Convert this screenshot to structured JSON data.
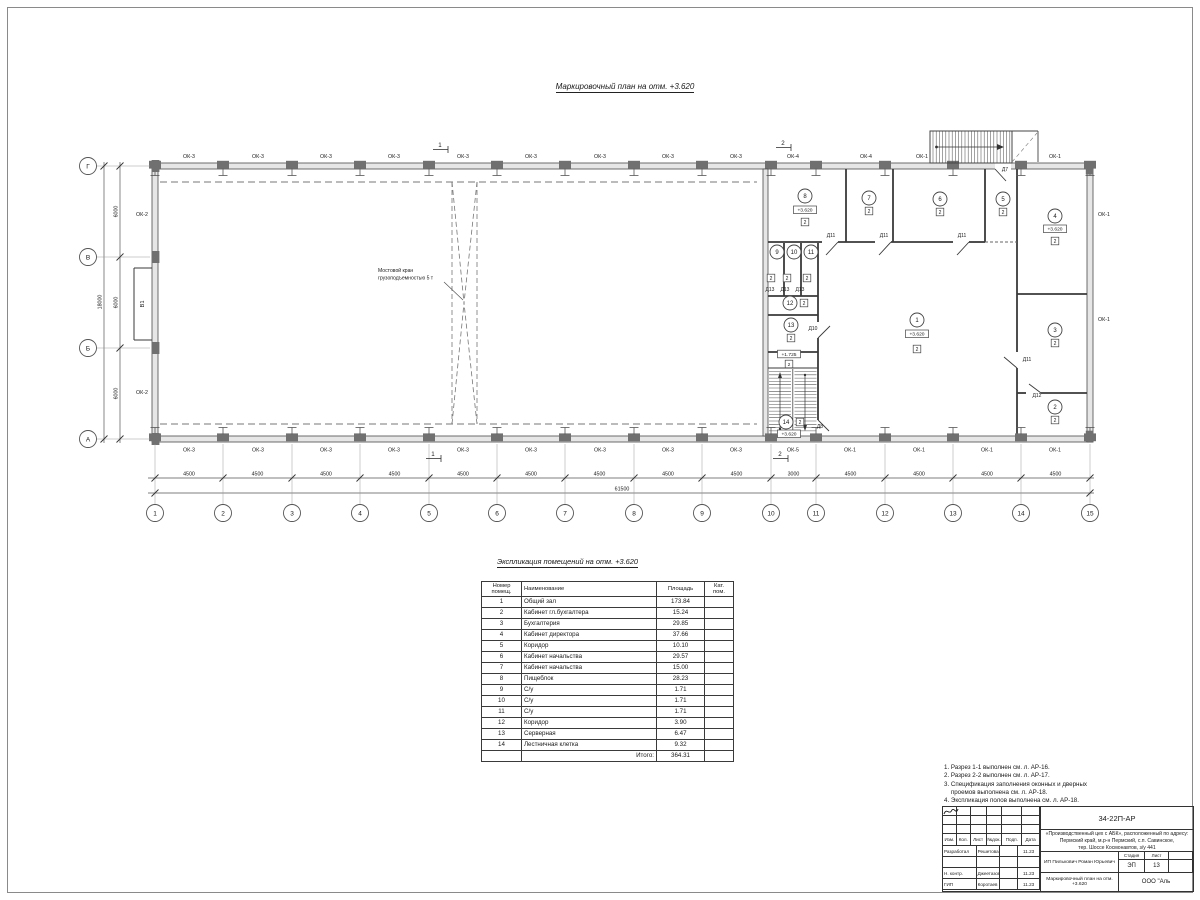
{
  "plan_title": "Маркировочный план  на отм. +3.620",
  "plan": {
    "axes_bottom": [
      "1",
      "2",
      "3",
      "4",
      "5",
      "6",
      "7",
      "8",
      "9",
      "10",
      "11",
      "12",
      "13",
      "14",
      "15"
    ],
    "axes_left": [
      "Г",
      "В",
      "Б",
      "А"
    ],
    "dims_bottom": [
      "4500",
      "4500",
      "4500",
      "4500",
      "4500",
      "4500",
      "4500",
      "4500",
      "4500",
      "3000",
      "4500",
      "4500",
      "4500",
      "4500"
    ],
    "dim_bottom_total": "61500",
    "dims_left": [
      "6000",
      "6000",
      "6000"
    ],
    "dim_left_total": "18000",
    "windows_top": [
      {
        "t": "ОК-3",
        "x": 189
      },
      {
        "t": "ОК-3",
        "x": 258
      },
      {
        "t": "ОК-3",
        "x": 326
      },
      {
        "t": "ОК-3",
        "x": 394
      },
      {
        "t": "ОК-3",
        "x": 463
      },
      {
        "t": "ОК-3",
        "x": 531
      },
      {
        "t": "ОК-3",
        "x": 600
      },
      {
        "t": "ОК-3",
        "x": 668
      },
      {
        "t": "ОК-3",
        "x": 736
      },
      {
        "t": "ОК-4",
        "x": 793
      },
      {
        "t": "ОК-4",
        "x": 866
      },
      {
        "t": "ОК-1",
        "x": 922
      },
      {
        "t": "ОК-1",
        "x": 1055
      }
    ],
    "windows_bottom": [
      {
        "t": "ОК-3",
        "x": 189
      },
      {
        "t": "ОК-3",
        "x": 258
      },
      {
        "t": "ОК-3",
        "x": 326
      },
      {
        "t": "ОК-3",
        "x": 394
      },
      {
        "t": "ОК-3",
        "x": 463
      },
      {
        "t": "ОК-3",
        "x": 531
      },
      {
        "t": "ОК-3",
        "x": 600
      },
      {
        "t": "ОК-3",
        "x": 668
      },
      {
        "t": "ОК-3",
        "x": 736
      },
      {
        "t": "ОК-5",
        "x": 793
      },
      {
        "t": "ОК-1",
        "x": 850
      },
      {
        "t": "ОК-1",
        "x": 919
      },
      {
        "t": "ОК-1",
        "x": 987
      },
      {
        "t": "ОК-1",
        "x": 1055
      }
    ],
    "windows_side": [
      {
        "t": "ОК-2",
        "x": 142,
        "y": 216
      },
      {
        "t": "ОК-2",
        "x": 142,
        "y": 394
      },
      {
        "t": "ОК-1",
        "x": 1098,
        "y": 216,
        "a": "start"
      },
      {
        "t": "ОК-1",
        "x": 1098,
        "y": 321,
        "a": "start"
      }
    ],
    "crane_note": [
      "Мостовой кран",
      "грузоподъемностью 5 т"
    ],
    "shaft_label": "В1",
    "rooms": [
      {
        "n": "1",
        "cx": 917,
        "cy": 320,
        "elev": "+3.620",
        "ex": 917,
        "ey": 334,
        "eb": true,
        "cat": "2",
        "kx": 917,
        "ky": 349
      },
      {
        "n": "2",
        "cx": 1055,
        "cy": 407,
        "cat": "2",
        "kx": 1055,
        "ky": 420
      },
      {
        "n": "3",
        "cx": 1055,
        "cy": 330,
        "cat": "2",
        "kx": 1055,
        "ky": 343
      },
      {
        "n": "4",
        "cx": 1055,
        "cy": 216,
        "elev": "+3.620",
        "ex": 1055,
        "ey": 229,
        "eb": true,
        "cat": "2",
        "kx": 1055,
        "ky": 241
      },
      {
        "n": "5",
        "cx": 1003,
        "cy": 199,
        "cat": "2",
        "kx": 1003,
        "ky": 212
      },
      {
        "n": "6",
        "cx": 940,
        "cy": 199,
        "cat": "2",
        "kx": 940,
        "ky": 212
      },
      {
        "n": "7",
        "cx": 869,
        "cy": 198,
        "cat": "2",
        "kx": 869,
        "ky": 211
      },
      {
        "n": "8",
        "cx": 805,
        "cy": 196,
        "elev": "+3.620",
        "ex": 805,
        "ey": 210,
        "eb": true,
        "cat": "2",
        "kx": 805,
        "ky": 222
      },
      {
        "n": "9",
        "cx": 777,
        "cy": 252,
        "cat": "2",
        "kx": 771,
        "ky": 278
      },
      {
        "n": "10",
        "cx": 794,
        "cy": 252,
        "cat": "2",
        "kx": 787,
        "ky": 278
      },
      {
        "n": "11",
        "cx": 811,
        "cy": 252,
        "cat": "2",
        "kx": 807,
        "ky": 278
      },
      {
        "n": "12",
        "cx": 790,
        "cy": 303,
        "cat": "2",
        "kx": 804,
        "ky": 303
      },
      {
        "n": "13",
        "cx": 791,
        "cy": 325,
        "cat": "2",
        "kx": 791,
        "ky": 338
      },
      {
        "n": "14",
        "cx": 786,
        "cy": 422,
        "cat": "2",
        "kx": 800,
        "ky": 422,
        "elev": "+3.620",
        "ex": 789,
        "ey": 434,
        "eb": true
      }
    ],
    "marks": [
      {
        "t": "+1.725",
        "x": 789,
        "y": 354
      },
      {
        "t": "2",
        "x": 789,
        "y": 364
      }
    ],
    "doors": [
      {
        "t": "Д7",
        "x": 1005,
        "y": 171
      },
      {
        "t": "Д11",
        "x": 831,
        "y": 237
      },
      {
        "t": "Д11",
        "x": 884,
        "y": 237
      },
      {
        "t": "Д11",
        "x": 962,
        "y": 237
      },
      {
        "t": "Д11",
        "x": 1027,
        "y": 361
      },
      {
        "t": "Д12",
        "x": 1037,
        "y": 397
      },
      {
        "t": "Д10",
        "x": 813,
        "y": 330
      },
      {
        "t": "Д13",
        "x": 770,
        "y": 291
      },
      {
        "t": "Д13",
        "x": 785,
        "y": 291
      },
      {
        "t": "Д13",
        "x": 800,
        "y": 291
      },
      {
        "t": "Д8",
        "x": 820,
        "y": 428
      }
    ],
    "sections": [
      {
        "t": "1",
        "x": 440,
        "y": 147
      },
      {
        "t": "1",
        "x": 433,
        "y": 456
      },
      {
        "t": "2",
        "x": 783,
        "y": 145
      },
      {
        "t": "2",
        "x": 780,
        "y": 456
      }
    ]
  },
  "table": {
    "title": "Экспликация помещений на отм. +3.620",
    "headers": [
      "Номер\nпомещ.",
      "Наименование",
      "Площадь",
      "Кат.\nпом."
    ],
    "rows": [
      [
        "1",
        "Общий зал",
        "173.84"
      ],
      [
        "2",
        "Кабинет гл.бухгалтера",
        "15.24"
      ],
      [
        "3",
        "Бухгалтерия",
        "29.85"
      ],
      [
        "4",
        "Кабинет директора",
        "37.66"
      ],
      [
        "5",
        "Коридор",
        "10.10"
      ],
      [
        "6",
        "Кабинет начальства",
        "29.57"
      ],
      [
        "7",
        "Кабинет начальства",
        "15.00"
      ],
      [
        "8",
        "Пищеблок",
        "28.23"
      ],
      [
        "9",
        "С/у",
        "1.71"
      ],
      [
        "10",
        "С/у",
        "1.71"
      ],
      [
        "11",
        "С/у",
        "1.71"
      ],
      [
        "12",
        "Коридор",
        "3.90"
      ],
      [
        "13",
        "Серверная",
        "6.47"
      ],
      [
        "14",
        "Лестничная клетка",
        "9.32"
      ]
    ],
    "total_label": "Итого:",
    "total_value": "364.31"
  },
  "notes": [
    "1. Разрез 1-1 выполнен см. л. АР-16.",
    "2. Разрез 2-2 выполнен см. л. АР-17.",
    "3. Спецификация заполнения оконных и дверных",
    "    проемов выполнена см. л. АР-18.",
    "4. Экспликация полов выполнена см. л. АР-18."
  ],
  "titleblock": {
    "doc_number": "34-22П-АР",
    "project": [
      "«Производственный цех с АБК», расположенный по адресу:",
      "Пермский край, м.р-н Пермский, с.п. Савинское,",
      "тер. Шоссе Космонавтов, з/у 441"
    ],
    "cols": [
      "Изм.",
      "Кол.",
      "Лист",
      "№док.",
      "Подп.",
      "Дата"
    ],
    "sign_rows": [
      [
        "Разработал",
        "Решетова",
        "11.23"
      ],
      [
        "",
        "",
        ""
      ],
      [
        "Н. контр.",
        "Джеетазов",
        "11.23"
      ],
      [
        "ГИП",
        "Коротаев",
        "11.23"
      ]
    ],
    "client": "ИП Пилькович Роман Юрьевич",
    "stage_label": "Стадия",
    "sheet_label": "Лист",
    "stage": "ЭП",
    "sheet": "13",
    "drawing_title": "Маркировочный план на отм. +3.620",
    "company": "ООО \"Аль"
  }
}
